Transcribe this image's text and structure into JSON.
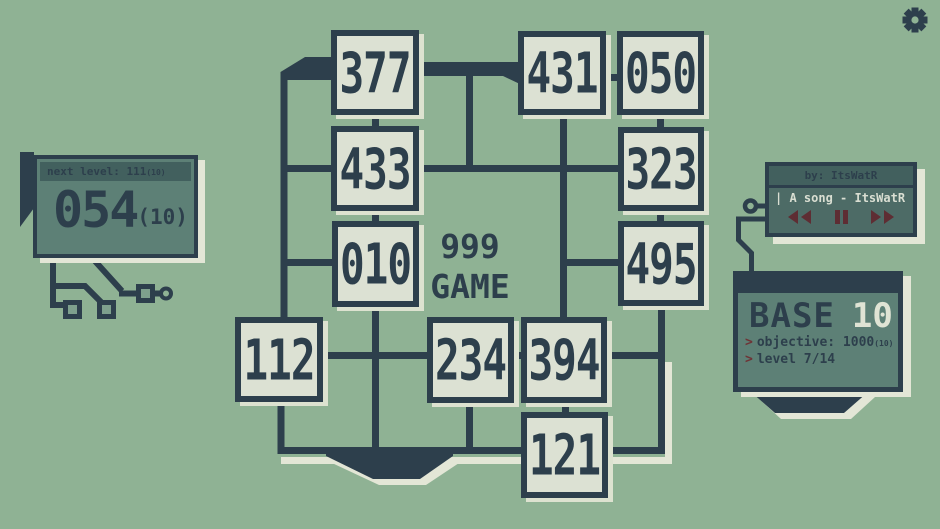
{
  "title": {
    "line1": "999",
    "line2": "GAME"
  },
  "score_panel": {
    "header": "next level: 111",
    "header_sub": "(10)",
    "value": "054",
    "value_sub": "(10)"
  },
  "music_panel": {
    "header": "by: ItsWatR",
    "song": "| A song - ItsWatR",
    "controls": [
      "rewind",
      "pause",
      "fast-forward"
    ]
  },
  "base_panel": {
    "title": "BASE",
    "base_value": "10",
    "lines": [
      {
        "prompt": ">",
        "text": "objective: 1000",
        "sub": "(10)"
      },
      {
        "prompt": ">",
        "text": "level 7/14",
        "sub": ""
      }
    ]
  },
  "board": {
    "tiles": [
      {
        "value": "377",
        "x": 331,
        "y": 30,
        "w": 88,
        "h": 85
      },
      {
        "value": "431",
        "x": 518,
        "y": 31,
        "w": 88,
        "h": 84
      },
      {
        "value": "050",
        "x": 617,
        "y": 31,
        "w": 87,
        "h": 84
      },
      {
        "value": "433",
        "x": 331,
        "y": 126,
        "w": 88,
        "h": 85
      },
      {
        "value": "323",
        "x": 618,
        "y": 127,
        "w": 86,
        "h": 84
      },
      {
        "value": "010",
        "x": 332,
        "y": 221,
        "w": 87,
        "h": 86
      },
      {
        "value": "495",
        "x": 618,
        "y": 221,
        "w": 86,
        "h": 85
      },
      {
        "value": "112",
        "x": 235,
        "y": 317,
        "w": 88,
        "h": 85
      },
      {
        "value": "234",
        "x": 427,
        "y": 317,
        "w": 87,
        "h": 86
      },
      {
        "value": "394",
        "x": 521,
        "y": 317,
        "w": 86,
        "h": 86
      },
      {
        "value": "121",
        "x": 521,
        "y": 412,
        "w": 87,
        "h": 86
      }
    ]
  },
  "icons": [
    "settings-gear-icon",
    "rewind-icon",
    "pause-icon",
    "fast-forward-icon"
  ],
  "colors": {
    "background": "#8fb294",
    "line_navy": "#2d3f4c",
    "tile_fill": "#dce1d3",
    "panel_teal": "#5d8076",
    "panel_header_teal": "#42605e",
    "music_body_teal": "#4d6b66",
    "cream_shadow": "#e3e6d6",
    "text_cream": "#d9ded2",
    "accent_maroon": "#5e2d33"
  }
}
